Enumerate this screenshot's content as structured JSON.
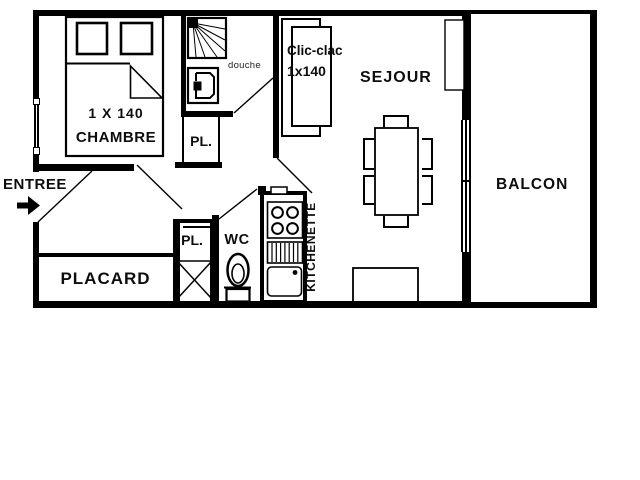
{
  "plan": {
    "title": "apartment-floor-plan",
    "colors": {
      "wall": "#000000",
      "background": "#ffffff",
      "text": "#0d0d0d"
    },
    "rooms": {
      "entree": {
        "label": "ENTREE"
      },
      "chambre": {
        "label": "CHAMBRE",
        "bed_size": "1 X 140"
      },
      "douche": {
        "label": "douche"
      },
      "closet_upper": {
        "label": "PL."
      },
      "closet_lower": {
        "label": "PL."
      },
      "wc": {
        "label": "WC"
      },
      "kitchenette": {
        "label": "KITCHENETTE"
      },
      "placard": {
        "label": "PLACARD"
      },
      "sejour": {
        "label": "SEJOUR"
      },
      "balcon": {
        "label": "BALCON"
      },
      "clic_clac": {
        "label": "Clic-clac",
        "size": "1x140"
      }
    }
  }
}
